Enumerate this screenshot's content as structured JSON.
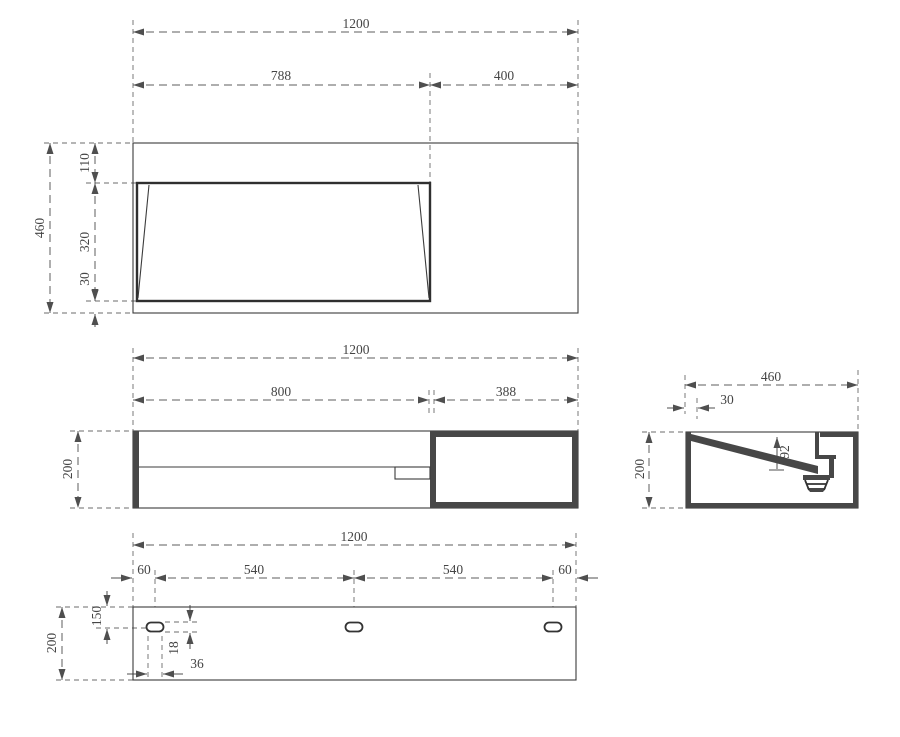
{
  "drawing": {
    "views": {
      "plan": {
        "dims": {
          "overall_width": "1200",
          "basin_span": "788",
          "right_span": "400",
          "overall_depth": "460",
          "top_inset": "110",
          "basin_depth": "320",
          "bottom_inset": "30"
        }
      },
      "front": {
        "dims": {
          "overall_width": "1200",
          "basin_span": "800",
          "shelf_span": "388",
          "height": "200"
        }
      },
      "side": {
        "dims": {
          "overall_depth": "460",
          "wall_offset": "30",
          "height": "200",
          "basin_drop": "92"
        }
      },
      "bottom": {
        "dims": {
          "overall_width": "1200",
          "edge_to_slot_left": "60",
          "slot_pitch_left": "540",
          "slot_pitch_right": "540",
          "edge_to_slot_right": "60",
          "overall_depth": "200",
          "slot_center_offset": "150",
          "slot_height": "18",
          "slot_length": "36"
        }
      }
    }
  }
}
